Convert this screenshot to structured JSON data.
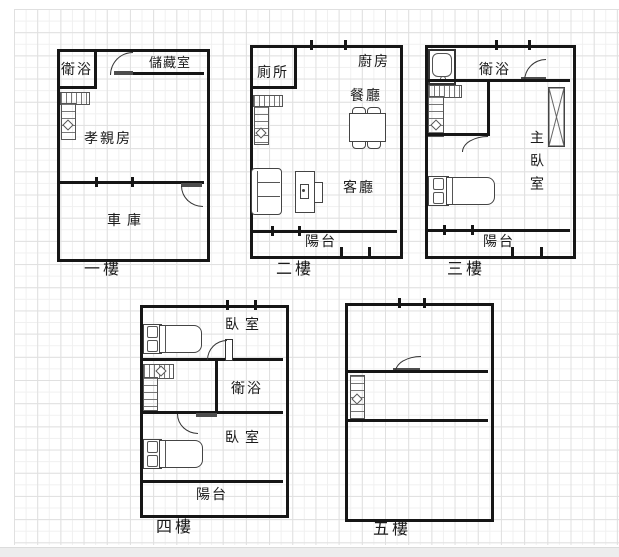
{
  "colors": {
    "wall": "#161616",
    "grid_major": "#e0e0e0",
    "grid_minor": "#f0f0f0",
    "background": "#ffffff",
    "footer_bar": "#ededed"
  },
  "floors": [
    {
      "id": "floor-1",
      "label": "一樓",
      "rooms": {
        "bathroom": "衛浴",
        "storage": "儲藏室",
        "parents_room": "孝親房",
        "garage": "車庫"
      },
      "icons": [
        "stairs",
        "door-swing",
        "door-swing"
      ]
    },
    {
      "id": "floor-2",
      "label": "二樓",
      "rooms": {
        "toilet": "廁所",
        "kitchen": "廚房",
        "dining_room": "餐廳",
        "living_room": "客廳",
        "balcony": "陽台"
      },
      "icons": [
        "stairs",
        "dining-table",
        "sofa",
        "tv-cabinet"
      ]
    },
    {
      "id": "floor-3",
      "label": "三樓",
      "rooms": {
        "bathroom": "衛浴",
        "master_bedroom": "主臥室",
        "balcony": "陽台"
      },
      "icons": [
        "bathtub",
        "stairs",
        "wardrobe",
        "bed",
        "door-swing",
        "door-swing"
      ]
    },
    {
      "id": "floor-4",
      "label": "四樓",
      "rooms": {
        "bedroom_upper": "臥室",
        "bathroom": "衛浴",
        "bedroom_lower": "臥室",
        "balcony": "陽台"
      },
      "icons": [
        "bed",
        "stairs",
        "bed",
        "door-swing",
        "door-swing"
      ]
    },
    {
      "id": "floor-5",
      "label": "五樓",
      "rooms": {},
      "icons": [
        "stairs",
        "door-swing"
      ]
    }
  ]
}
